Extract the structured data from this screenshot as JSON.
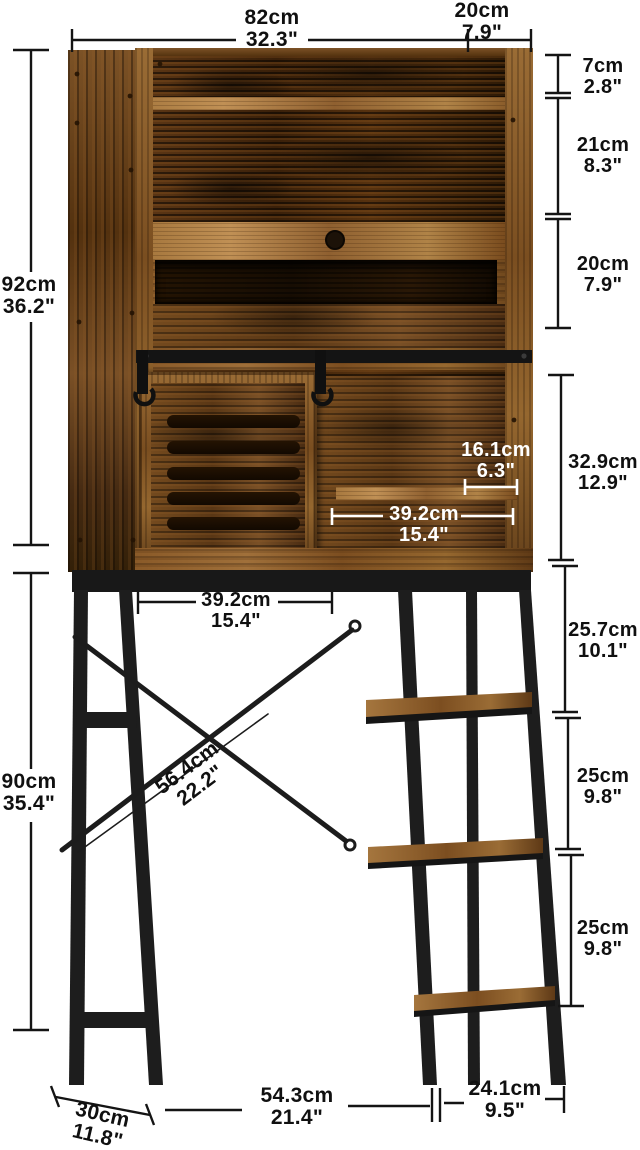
{
  "title": "Over-the-toilet storage cabinet dimension diagram",
  "colors": {
    "background": "#ffffff",
    "dim_line": "#141414",
    "dim_line_inner": "#ffffff",
    "wood_light": "#a97a42",
    "wood_dark": "#3a2009",
    "metal": "#1d1d1d"
  },
  "dimensions": {
    "top_width": {
      "cm": "82cm",
      "inch": "32.3\""
    },
    "top_depth": {
      "cm": "20cm",
      "inch": "7.9\""
    },
    "right": [
      {
        "cm": "7cm",
        "inch": "2.8\""
      },
      {
        "cm": "21cm",
        "inch": "8.3\""
      },
      {
        "cm": "20cm",
        "inch": "7.9\""
      },
      {
        "cm": "32.9cm",
        "inch": "12.9\""
      },
      {
        "cm": "25.7cm",
        "inch": "10.1\""
      },
      {
        "cm": "25cm",
        "inch": "9.8\""
      },
      {
        "cm": "25cm",
        "inch": "9.8\""
      }
    ],
    "left_upper": {
      "cm": "92cm",
      "inch": "36.2\""
    },
    "left_lower": {
      "cm": "90cm",
      "inch": "35.4\""
    },
    "inner_shelf": {
      "cm": "16.1cm",
      "inch": "6.3\""
    },
    "inner_width": {
      "cm": "39.2cm",
      "inch": "15.4\""
    },
    "frame_width": {
      "cm": "39.2cm",
      "inch": "15.4\""
    },
    "diagonal": {
      "cm": "56.4cm",
      "inch": "22.2\""
    },
    "base_depth": {
      "cm": "30cm",
      "inch": "11.8\""
    },
    "base_left": {
      "cm": "54.3cm",
      "inch": "21.4\""
    },
    "base_right": {
      "cm": "24.1cm",
      "inch": "9.5\""
    }
  }
}
